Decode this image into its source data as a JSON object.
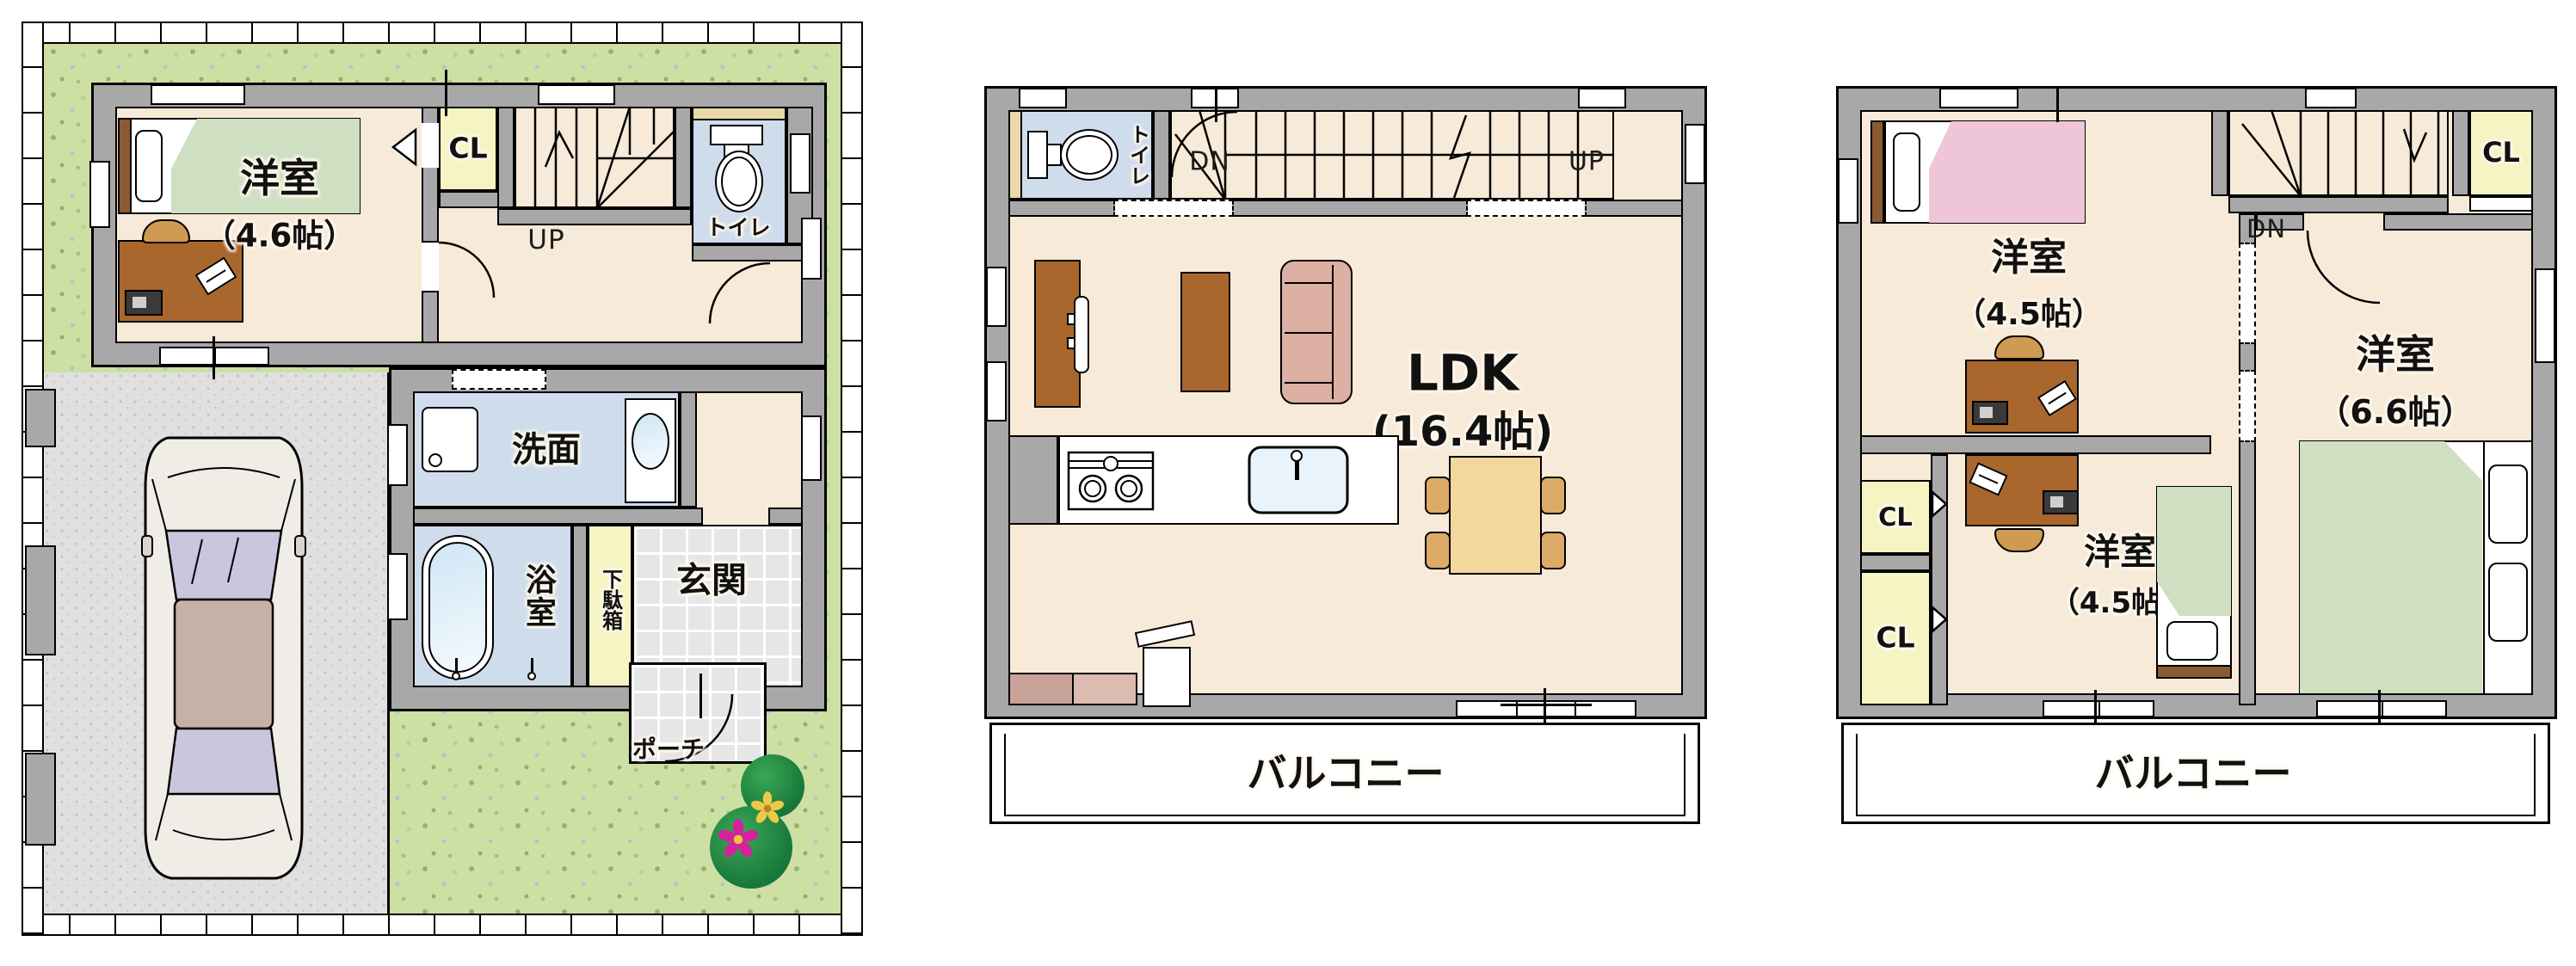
{
  "colors": {
    "wall": "#a8a8a8",
    "floor": "#f8ead8",
    "garden": "#cddfa3",
    "driveway": "#e0e0e0",
    "wet_room": "#cfdcec",
    "closet": "#f6f4c3",
    "bed_green": "#cfe0c2",
    "bed_pink": "#eec6d8",
    "wood_furniture": "#a9662d",
    "dining_table": "#f4d79e",
    "sofa": "#dcb0a2",
    "entrance_tile": "#e6e6e6"
  },
  "floor1": {
    "bedroom": {
      "name": "洋室",
      "size": "（4.6帖）"
    },
    "closet_label": "CL",
    "stairs_up_label": "UP",
    "toilet_label": "トイレ",
    "washroom_label": "洗面",
    "bathroom_label": "浴室",
    "shoe_cabinet_label": "下駄箱",
    "entrance_label": "玄関",
    "porch_label": "ポーチ"
  },
  "floor2": {
    "toilet_label": "トイレ",
    "stairs_down_label": "DN",
    "stairs_up_label": "UP",
    "ldk": {
      "name": "LDK",
      "size": "(16.4帖)"
    },
    "balcony_label": "バルコニー"
  },
  "floor3": {
    "bedroom_a": {
      "name": "洋室",
      "size": "（4.5帖）"
    },
    "stairs_down_label": "DN",
    "closet_a_label": "CL",
    "bedroom_b": {
      "name": "洋室",
      "size": "（6.6帖）"
    },
    "closet_b_label": "CL",
    "closet_c_label": "CL",
    "bedroom_c": {
      "name": "洋室",
      "size": "（4.5帖）"
    },
    "balcony_label": "バルコニー"
  }
}
